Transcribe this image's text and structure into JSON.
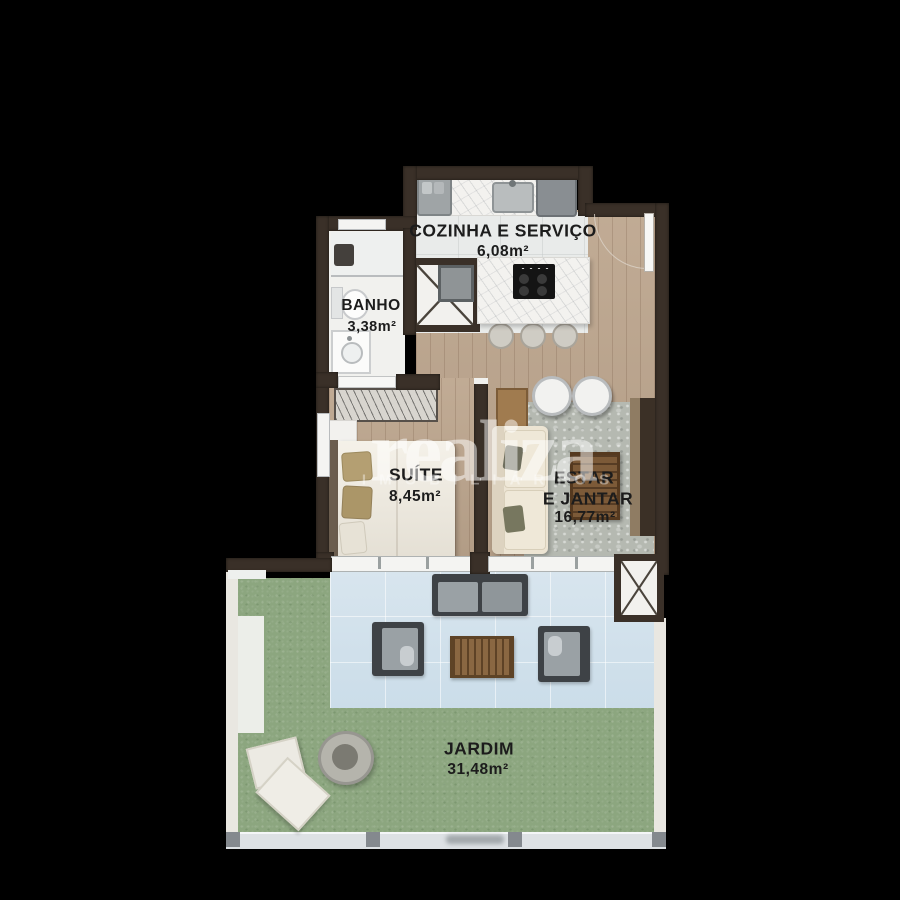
{
  "title": "apartment floor plan with garden",
  "rooms": {
    "cozinha": {
      "name": "COZINHA E SERVIÇO",
      "area": "6,08m²"
    },
    "banho": {
      "name": "BANHO",
      "area": "3,38m²"
    },
    "suite": {
      "name": "SUÍTE",
      "area": "8,45m²"
    },
    "estar": {
      "name_line1": "ESTAR",
      "name_line2": "E JANTAR",
      "area": "16,77m²"
    },
    "jardim": {
      "name": "JARDIM",
      "area": "31,48m²"
    }
  },
  "watermark": {
    "logo": "realiza",
    "subtitle": "IMOBILIÁRIOS"
  },
  "colors": {
    "background": "#000000",
    "wall": "#3a3028",
    "wood_floor": "#bda68e",
    "kitchen_tile": "#e9ebea",
    "patio_tile": "#d2e1eb",
    "grass": "#8ca67f",
    "label_text": "#1c1c1c",
    "watermark": "#ffffff"
  }
}
